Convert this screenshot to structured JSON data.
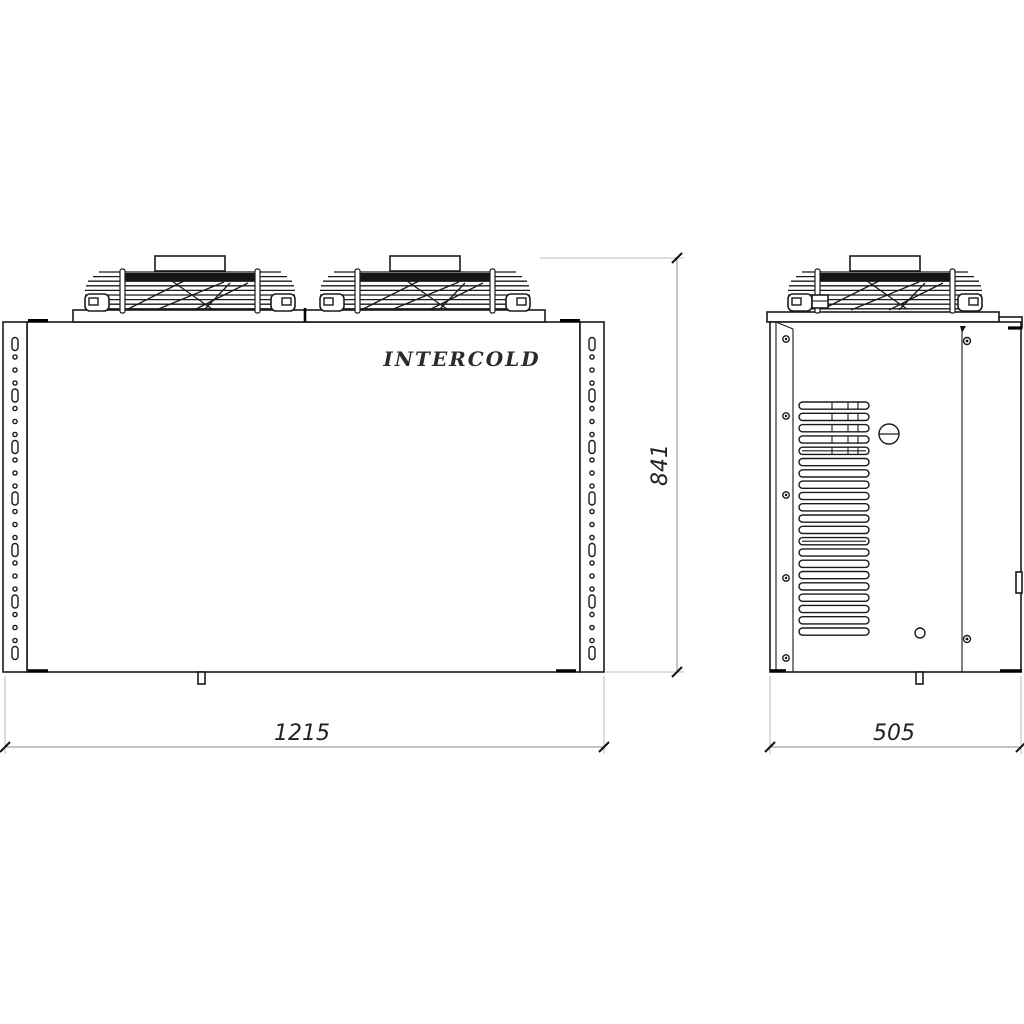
{
  "drawing": {
    "brand": "INTERCOLD",
    "dimensions_mm": {
      "width": "1215",
      "height": "841",
      "depth": "505"
    },
    "features": {
      "front_fan_count": 2,
      "side_fan_count": 1,
      "side_louver_count": 21,
      "louver_divided_count": 5,
      "bracket_slot_count": 7,
      "bracket_dots_per_gap": 3,
      "side_left_screw_count": 5,
      "side_right_screw_count": 2
    },
    "colors": {
      "line": "#1a1a1a",
      "dimension_line": "#888888",
      "extension_line": "#bbbbbb",
      "text": "#222222",
      "background": "#ffffff"
    }
  }
}
